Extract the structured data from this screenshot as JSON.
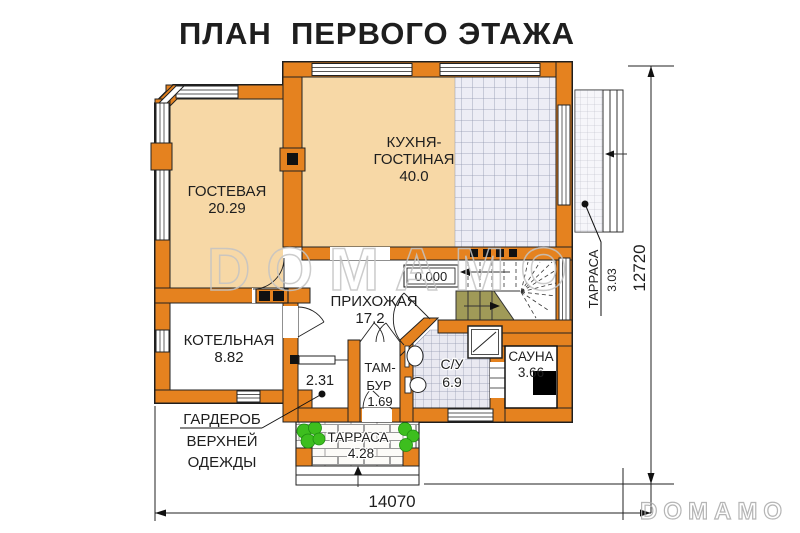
{
  "title": "ПЛАН  ПЕРВОГО ЭТАЖА",
  "watermark": {
    "center": "DOMAMO",
    "corner": "DOMAMO"
  },
  "rooms": {
    "guest": {
      "name": "ГОСТЕВАЯ",
      "area": "20.29"
    },
    "kitchen_living": {
      "name_line1": "КУХНЯ-",
      "name_line2": "ГОСТИНАЯ",
      "area": "40.0"
    },
    "boiler": {
      "name": "КОТЕЛЬНАЯ",
      "area": "8.82"
    },
    "hallway": {
      "name": "ПРИХОЖАЯ",
      "area": "17.2"
    },
    "wardrobe": {
      "area": "2.31"
    },
    "tambour": {
      "name_line1": "ТАМ-",
      "name_line2": "БУР",
      "area": "1.69"
    },
    "bathroom": {
      "name": "С/У",
      "area": "6.9"
    },
    "sauna": {
      "name": "САУНА",
      "area": "3.66"
    }
  },
  "terraces": {
    "right": {
      "name": "ТАРРАСА",
      "area": "3.03"
    },
    "bottom": {
      "name": "ТАРРАСА",
      "area": "4.28"
    }
  },
  "annotations": {
    "wardrobe_note": {
      "line1": "ГАРДЕРОБ",
      "line2": "ВЕРХНЕЙ",
      "line3": "ОДЕЖДЫ"
    },
    "level_mark": "0.000"
  },
  "dimensions": {
    "horizontal": "14070",
    "vertical": "12720"
  },
  "colors": {
    "wall": "#E5821F",
    "room_fill": "#F7D8A6",
    "tile_fill": "#EDEDF5",
    "stairs_fill": "#A09A58",
    "plant": "#3DBE1E",
    "watermark": "#C4C4C4"
  }
}
